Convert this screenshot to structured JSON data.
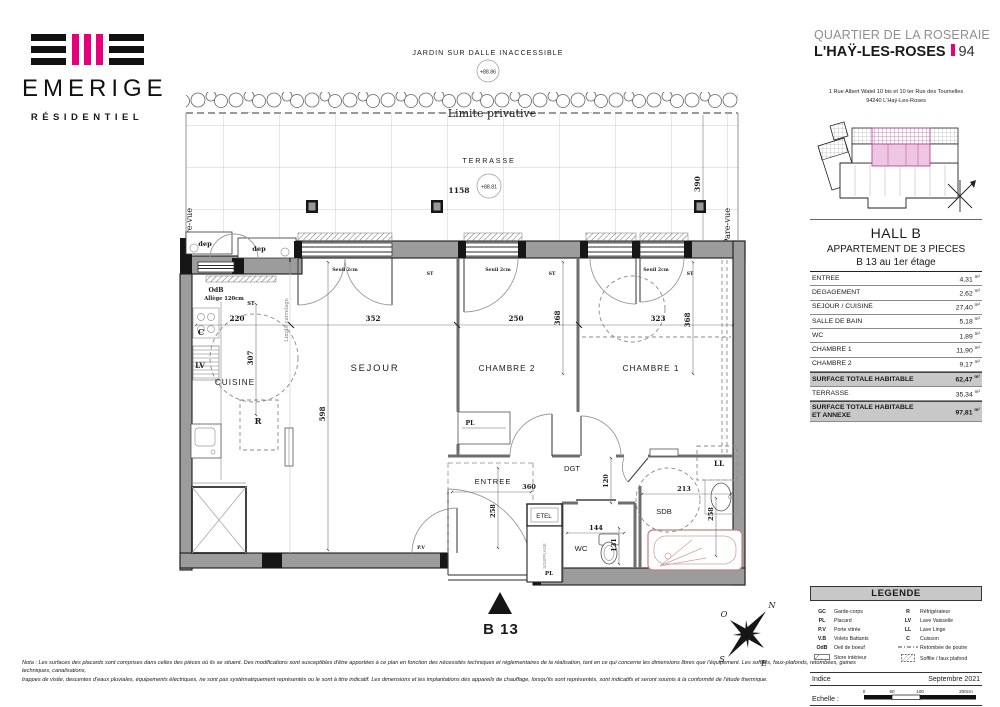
{
  "colors": {
    "accent": "#e6007e",
    "wall": "#9c9c9c",
    "total_row_bg": "#c8c8c8"
  },
  "logo": {
    "name": "EMERIGE",
    "tagline": "RÉSIDENTIEL"
  },
  "header": {
    "project": "QUARTIER DE LA ROSERAIE",
    "city": "L'HAŸ-LES-ROSES",
    "dept": "94",
    "address1": "1 Rue Albert Watel 10 bis et 10 ter Rue des Tournelles",
    "address2": "94240 L'Haÿ-Les-Roses"
  },
  "unit": {
    "hall": "HALL B",
    "type": "APPARTEMENT DE 3 PIECES",
    "floor": "B 13 au 1er étage"
  },
  "areas": {
    "unit": "m²",
    "rows": [
      {
        "label": "ENTREE",
        "value": "4,31"
      },
      {
        "label": "DEGAGEMENT",
        "value": "2,62"
      },
      {
        "label": "SEJOUR / CUISINE",
        "value": "27,40"
      },
      {
        "label": "SALLE DE BAIN",
        "value": "5,18"
      },
      {
        "label": "WC",
        "value": "1,89"
      },
      {
        "label": "CHAMBRE 1",
        "value": "11,90"
      },
      {
        "label": "CHAMBRE 2",
        "value": "9,17"
      },
      {
        "label": "SURFACE TOTALE HABITABLE",
        "value": "62,47"
      },
      {
        "label": "TERRASSE",
        "value": "35,34"
      },
      {
        "label": "SURFACE TOTALE HABITABLE ET ANNEXE",
        "value": "97,81"
      }
    ]
  },
  "legend": {
    "title": "LEGENDE",
    "col1": [
      {
        "abbr": "GC",
        "label": "Garde-corps"
      },
      {
        "abbr": "PL",
        "label": "Placard"
      },
      {
        "abbr": "P.V",
        "label": "Porte vitrée"
      },
      {
        "abbr": "V.B",
        "label": "Volets Battants"
      },
      {
        "abbr": "OdB",
        "label": "Oeil de boeuf"
      },
      {
        "abbr": "",
        "symbol": "store-interieur",
        "label": "Store intérieur"
      }
    ],
    "col2": [
      {
        "abbr": "R",
        "label": "Réfrigérateur"
      },
      {
        "abbr": "LV",
        "label": "Lave Vaisselle"
      },
      {
        "abbr": "LL",
        "label": "Lave Linge"
      },
      {
        "abbr": "C",
        "label": "Cuisson"
      },
      {
        "abbr": "",
        "symbol": "retombee-de-poutre",
        "label": "Retombée de poutre"
      },
      {
        "abbr": "",
        "symbol": "soffite",
        "label": "Soffite / faux plafond"
      }
    ]
  },
  "footer": {
    "indice_label": "Indice",
    "indice_value": "Septembre 2021",
    "scale_label": "Echelle :",
    "ticks": [
      "0",
      "50",
      "100",
      "200cm"
    ]
  },
  "note": {
    "line1": "Nota : Les surfaces des placards sont comprises dans celles des pièces où ils se situent. Des modifications sont susceptibles d'être apportées à ce plan en fonction des nécessités techniques et réglementaires de la réalisation, tant en ce qui concerne les dimensions libres que l'équipement.  Les soffites, faux-plafonds, retombées, gaines techniques, canalisations,",
    "line2": "trappes de visite, descentes d'eaux pluviales, équipements électriques, ne sont pas systématiquement représentés ou le sont à titre indicatif. Les dimensions et les implantations des appareils de chauffage, lorsqu'ils sont représentés, sont indicatifs et seront soumis à la conformité de l'étude thermique."
  },
  "plan": {
    "jardin": "JARDIN SUR DALLE INACCESSIBLE",
    "jardin_level": "+88.86",
    "limite_privative": "Limite privative",
    "terrasse": "TERRASSE",
    "terrasse_level": "+88.81",
    "pare_vue": "Pare-vue",
    "limite_carrelage": "Limite carrelage",
    "dep": "dep",
    "odb": "OdB",
    "allege": "Allège 120cm",
    "st": "ST",
    "seuil": "Seuil 2cm",
    "souffl": "SOUFFLAGE",
    "rooms": {
      "cuisine": "CUISINE",
      "sejour": "SEJOUR",
      "chambre1": "CHAMBRE 1",
      "chambre2": "CHAMBRE 2",
      "entree": "ENTREE",
      "dgt": "DGT",
      "wc": "WC",
      "sdb": "SDB",
      "etel": "ETEL"
    },
    "tags": {
      "c": "C",
      "lv": "LV",
      "r": "R",
      "ll": "LL",
      "pl": "PL",
      "pv": "P.V"
    },
    "dims": {
      "terrace_w": "1158",
      "terrace_side": "390",
      "cuisine_w": "220",
      "sejour_w": "352",
      "chambre2_w": "250",
      "chambre1_w": "323",
      "cuisine_d": "307",
      "sejour_d": "598",
      "chambre1_d": "368",
      "entree_w": "360",
      "entree_d": "258",
      "dgt_d": "120",
      "wc_w": "144",
      "wc_d": "131",
      "sdb_w": "213",
      "sdb_d": "258"
    },
    "unit_label": "B 13",
    "compass": {
      "n": "N",
      "e": "E",
      "s": "S",
      "o": "O"
    }
  }
}
